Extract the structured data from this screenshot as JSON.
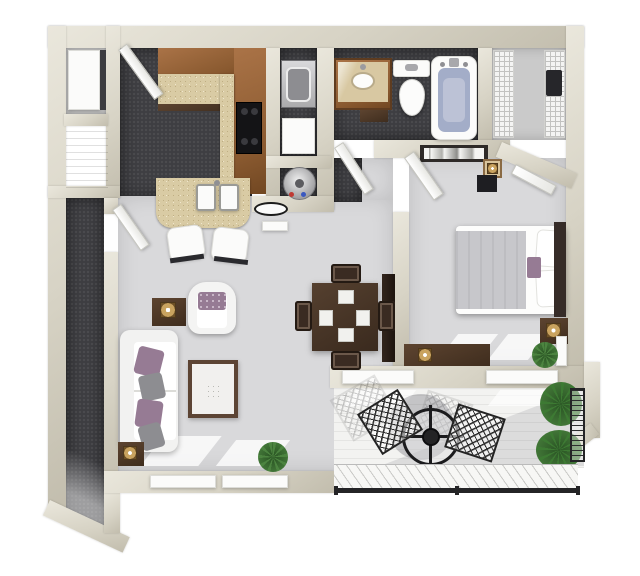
{
  "scene": {
    "type": "3d-floorplan-render",
    "description": "Top-down 3D rendering of a one-bedroom, one-bath apartment with balcony",
    "visible_text": "none"
  },
  "colors": {
    "wall": "#d7d3c5",
    "wall_hi": "#eae7dc",
    "wall_lo": "#c2bdad",
    "floor_dark": "#3e3e42",
    "floor_light": "#d9d9db",
    "floor_closet": "#cacaca",
    "balcony_floor": "#f3f3f1",
    "wood": "#996538",
    "wood_dark": "#6f4523",
    "granite": "#d9cba4",
    "granite_dot": "#bfae83",
    "marble": "#d8c8a2",
    "white_furniture": "#f6f6f5",
    "pillow_purple": "#967b94",
    "pillow_gray": "#8d8d91",
    "table_brown": "#49352a",
    "blanket_gray": "#c7c7cb",
    "headboard": "#362c28",
    "water_blue": "#a3adc8",
    "plant": "#4c8440",
    "plant_dark": "#2f5c28",
    "metal_black": "#1f1f22",
    "lamp_gold": "#c9a35f",
    "appliance_gray": "#b9b9bb"
  },
  "rooms": [
    {
      "name": "kitchen",
      "floor": "dark-carpet",
      "items": [
        "upper-cabinets-L",
        "granite-countertop",
        "black-range",
        "double-basin-sink",
        "breakfast-bar",
        "bar-chair",
        "bar-chair",
        "swing-door"
      ]
    },
    {
      "name": "entry-closets",
      "items": [
        "white-appliance",
        "wood-panel-door"
      ]
    },
    {
      "name": "laundry-closet",
      "items": [
        "washer",
        "dryer"
      ]
    },
    {
      "name": "utility-closet",
      "items": [
        "water-heater"
      ]
    },
    {
      "name": "bathroom",
      "floor": "dark-carpet",
      "items": [
        "wood-vanity-marble-top",
        "oval-sink",
        "toilet",
        "bathtub-blue-water",
        "swing-door"
      ]
    },
    {
      "name": "walk-in-closet",
      "items": [
        "wire-shelf-left",
        "wire-shelf-right",
        "hanging-clothes",
        "swing-door"
      ]
    },
    {
      "name": "bedroom",
      "floor": "light-carpet",
      "items": [
        "queen-bed-white-gray",
        "dark-headboard",
        "purple-accent-pillow",
        "nightstand-with-lamp",
        "long-dresser-with-lamp",
        "panoramic-wall-art",
        "accent-table-lamp",
        "dark-storage-box",
        "potted-plant",
        "floor-mirror",
        "swing-door"
      ]
    },
    {
      "name": "living-dining",
      "floor": "light-carpet",
      "items": [
        "white-sofa",
        "purple-pillow",
        "gray-pillow",
        "purple-pillow",
        "gray-pillow",
        "armchair-with-pillow",
        "side-table-lamp",
        "side-table-lamp",
        "framed-area-rug",
        "media-console",
        "square-dining-table",
        "placemat",
        "placemat",
        "placemat",
        "placemat",
        "dining-chair",
        "dining-chair",
        "dining-chair",
        "dining-chair",
        "potted-plant",
        "oval-wall-mirror",
        "wall-plate",
        "window",
        "window"
      ]
    },
    {
      "name": "entry-hall",
      "floor": "dark-carpet",
      "items": [
        "swing-door",
        "chamfered-end-wall"
      ]
    },
    {
      "name": "balcony",
      "floor": "white-plank-deck",
      "items": [
        "bistro-table-with-umbrella",
        "lattice-patio-chair",
        "lattice-patio-chair",
        "potted-palm",
        "potted-palm",
        "black-railing-bottom",
        "black-railing-right",
        "hatched-deck-edge",
        "window",
        "window"
      ]
    }
  ]
}
